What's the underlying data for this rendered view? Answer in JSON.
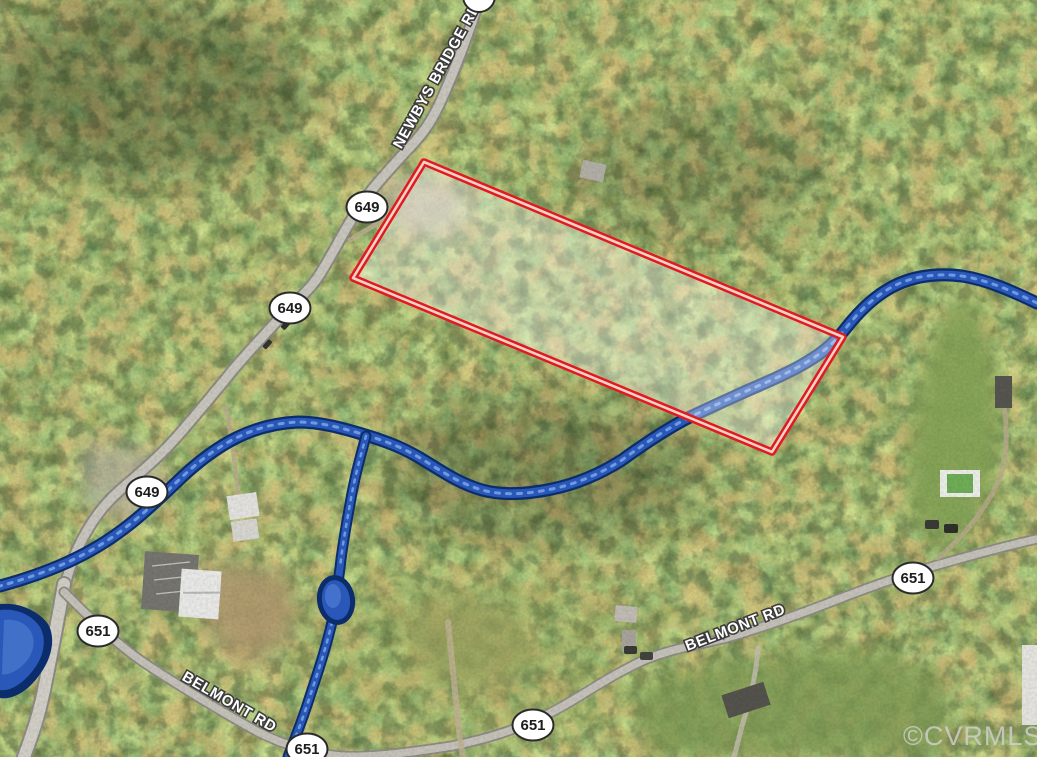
{
  "map": {
    "watermark": "©CVRMLS",
    "road_labels": {
      "newbys_bridge_rd": "NEWBYS BRIDGE RD",
      "belmont_rd_left": "BELMONT RD",
      "belmont_rd_right": "BELMONT RD"
    },
    "route_shields": [
      {
        "id": "649-north",
        "route": "649"
      },
      {
        "id": "649-mid",
        "route": "649"
      },
      {
        "id": "649-south",
        "route": "649"
      },
      {
        "id": "651-west",
        "route": "651"
      },
      {
        "id": "651-bottom-left",
        "route": "651"
      },
      {
        "id": "651-bottom-center",
        "route": "651"
      },
      {
        "id": "651-east",
        "route": "651"
      }
    ],
    "colors": {
      "parcel_outline": "#e11a1f",
      "parcel_fill": "rgba(255,255,255,0.33)",
      "stream_core": "#2a58b8",
      "stream_casing": "#0b2d6b",
      "road_surface": "#c9c6be",
      "label_text": "#ffffff",
      "label_halo": "#3c3c3c",
      "shield_fill": "#ffffff",
      "watermark_color": "#d2d2d2"
    }
  }
}
